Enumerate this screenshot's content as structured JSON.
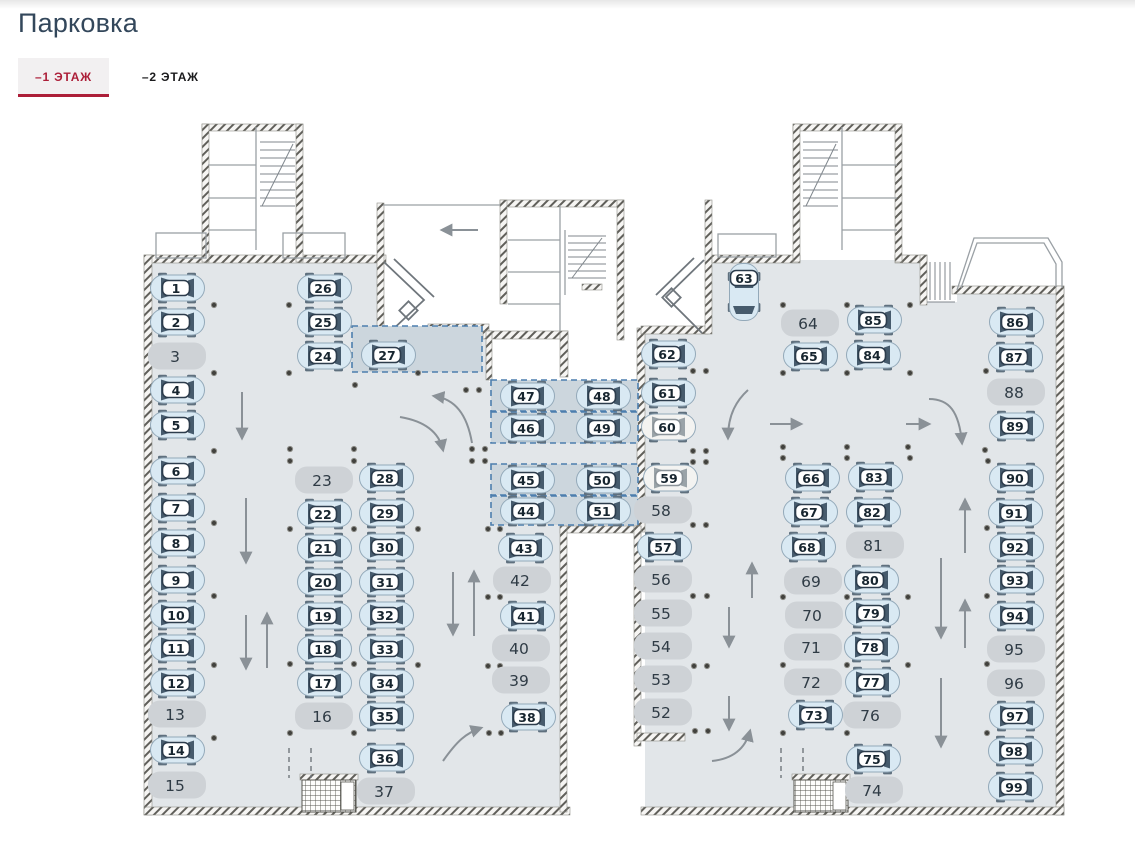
{
  "page": {
    "title": "Парковка"
  },
  "tabs": {
    "floor1": {
      "label": "–1 ЭТАЖ",
      "active": true
    },
    "floor2": {
      "label": "–2 ЭТАЖ",
      "active": false
    }
  },
  "plan": {
    "colors": {
      "floor": "#e2e6e9",
      "zone_fill": "#ccd6dd",
      "zone_border": "#4d7fae",
      "car_body": "#d9e9f3",
      "car_roof": "#eef5f9",
      "car_glass": "#465b6d",
      "car_wheel": "#5f707e",
      "car_outline": "#93a9b9",
      "white_body": "#f3f3f1",
      "white_glass": "#9aa3a8",
      "free_fill": "#ced2d6",
      "badge_fill": "#ffffff",
      "badge_border": "#2c3c4c",
      "number": "#17252f"
    },
    "zones": [
      {
        "x": 352,
        "y": 326,
        "w": 130,
        "h": 46
      },
      {
        "x": 491,
        "y": 380,
        "w": 147,
        "h": 31
      },
      {
        "x": 491,
        "y": 412,
        "w": 147,
        "h": 31
      },
      {
        "x": 491,
        "y": 464,
        "w": 147,
        "h": 31
      },
      {
        "x": 491,
        "y": 496,
        "w": 147,
        "h": 29
      }
    ],
    "spots": [
      {
        "n": 1,
        "x": 177,
        "y": 288,
        "s": "c"
      },
      {
        "n": 2,
        "x": 177,
        "y": 322,
        "s": "c"
      },
      {
        "n": 3,
        "x": 177,
        "y": 356,
        "s": "f"
      },
      {
        "n": 4,
        "x": 177,
        "y": 390,
        "s": "c"
      },
      {
        "n": 5,
        "x": 177,
        "y": 425,
        "s": "c"
      },
      {
        "n": 6,
        "x": 177,
        "y": 471,
        "s": "c"
      },
      {
        "n": 7,
        "x": 177,
        "y": 508,
        "s": "c"
      },
      {
        "n": 8,
        "x": 177,
        "y": 543,
        "s": "c"
      },
      {
        "n": 9,
        "x": 177,
        "y": 580,
        "s": "c"
      },
      {
        "n": 10,
        "x": 177,
        "y": 615,
        "s": "c"
      },
      {
        "n": 11,
        "x": 177,
        "y": 648,
        "s": "c"
      },
      {
        "n": 12,
        "x": 177,
        "y": 683,
        "s": "c"
      },
      {
        "n": 13,
        "x": 177,
        "y": 714,
        "s": "f"
      },
      {
        "n": 14,
        "x": 177,
        "y": 750,
        "s": "c"
      },
      {
        "n": 15,
        "x": 177,
        "y": 785,
        "s": "f"
      },
      {
        "n": 16,
        "x": 324,
        "y": 716,
        "s": "f"
      },
      {
        "n": 17,
        "x": 324,
        "y": 683,
        "s": "c"
      },
      {
        "n": 18,
        "x": 324,
        "y": 649,
        "s": "c"
      },
      {
        "n": 19,
        "x": 324,
        "y": 616,
        "s": "c"
      },
      {
        "n": 20,
        "x": 324,
        "y": 582,
        "s": "c"
      },
      {
        "n": 21,
        "x": 324,
        "y": 548,
        "s": "c"
      },
      {
        "n": 22,
        "x": 324,
        "y": 514,
        "s": "c"
      },
      {
        "n": 23,
        "x": 324,
        "y": 480,
        "s": "f"
      },
      {
        "n": 24,
        "x": 324,
        "y": 356,
        "s": "c"
      },
      {
        "n": 25,
        "x": 324,
        "y": 322,
        "s": "c"
      },
      {
        "n": 26,
        "x": 324,
        "y": 288,
        "s": "c"
      },
      {
        "n": 27,
        "x": 388,
        "y": 355,
        "s": "c"
      },
      {
        "n": 28,
        "x": 386,
        "y": 478,
        "s": "c"
      },
      {
        "n": 29,
        "x": 386,
        "y": 513,
        "s": "c"
      },
      {
        "n": 30,
        "x": 386,
        "y": 547,
        "s": "c"
      },
      {
        "n": 31,
        "x": 386,
        "y": 582,
        "s": "c"
      },
      {
        "n": 32,
        "x": 386,
        "y": 615,
        "s": "c"
      },
      {
        "n": 33,
        "x": 386,
        "y": 649,
        "s": "c"
      },
      {
        "n": 34,
        "x": 386,
        "y": 683,
        "s": "c"
      },
      {
        "n": 35,
        "x": 386,
        "y": 716,
        "s": "c"
      },
      {
        "n": 36,
        "x": 386,
        "y": 758,
        "s": "c"
      },
      {
        "n": 37,
        "x": 386,
        "y": 791,
        "s": "f"
      },
      {
        "n": 38,
        "x": 528,
        "y": 717,
        "s": "c"
      },
      {
        "n": 39,
        "x": 521,
        "y": 680,
        "s": "f"
      },
      {
        "n": 40,
        "x": 521,
        "y": 648,
        "s": "f"
      },
      {
        "n": 41,
        "x": 527,
        "y": 616,
        "s": "c"
      },
      {
        "n": 42,
        "x": 522,
        "y": 580,
        "s": "f"
      },
      {
        "n": 43,
        "x": 525,
        "y": 548,
        "s": "c"
      },
      {
        "n": 44,
        "x": 527,
        "y": 511,
        "s": "c"
      },
      {
        "n": 45,
        "x": 527,
        "y": 480,
        "s": "c"
      },
      {
        "n": 46,
        "x": 527,
        "y": 428,
        "s": "c"
      },
      {
        "n": 47,
        "x": 527,
        "y": 396,
        "s": "c"
      },
      {
        "n": 48,
        "x": 603,
        "y": 396,
        "s": "c"
      },
      {
        "n": 49,
        "x": 603,
        "y": 428,
        "s": "c"
      },
      {
        "n": 50,
        "x": 603,
        "y": 480,
        "s": "c"
      },
      {
        "n": 51,
        "x": 603,
        "y": 511,
        "s": "c"
      },
      {
        "n": 52,
        "x": 663,
        "y": 712,
        "s": "f"
      },
      {
        "n": 53,
        "x": 663,
        "y": 679,
        "s": "f"
      },
      {
        "n": 54,
        "x": 663,
        "y": 646,
        "s": "f"
      },
      {
        "n": 55,
        "x": 663,
        "y": 613,
        "s": "f"
      },
      {
        "n": 56,
        "x": 663,
        "y": 579,
        "s": "f"
      },
      {
        "n": 57,
        "x": 664,
        "y": 547,
        "s": "c"
      },
      {
        "n": 58,
        "x": 663,
        "y": 510,
        "s": "f"
      },
      {
        "n": 59,
        "x": 670,
        "y": 478,
        "s": "w"
      },
      {
        "n": 60,
        "x": 668,
        "y": 427,
        "s": "w"
      },
      {
        "n": 61,
        "x": 668,
        "y": 393,
        "s": "c"
      },
      {
        "n": 62,
        "x": 668,
        "y": 354,
        "s": "c"
      },
      {
        "n": 63,
        "x": 744,
        "y": 292,
        "s": "v"
      },
      {
        "n": 64,
        "x": 810,
        "y": 323,
        "s": "f"
      },
      {
        "n": 65,
        "x": 810,
        "y": 356,
        "s": "c"
      },
      {
        "n": 66,
        "x": 812,
        "y": 478,
        "s": "c"
      },
      {
        "n": 67,
        "x": 810,
        "y": 512,
        "s": "c"
      },
      {
        "n": 68,
        "x": 808,
        "y": 547,
        "s": "c"
      },
      {
        "n": 69,
        "x": 813,
        "y": 581,
        "s": "f"
      },
      {
        "n": 70,
        "x": 814,
        "y": 615,
        "s": "f"
      },
      {
        "n": 71,
        "x": 813,
        "y": 647,
        "s": "f"
      },
      {
        "n": 72,
        "x": 813,
        "y": 682,
        "s": "f"
      },
      {
        "n": 73,
        "x": 815,
        "y": 715,
        "s": "c"
      },
      {
        "n": 74,
        "x": 874,
        "y": 790,
        "s": "f"
      },
      {
        "n": 75,
        "x": 873,
        "y": 759,
        "s": "c"
      },
      {
        "n": 76,
        "x": 872,
        "y": 715,
        "s": "f"
      },
      {
        "n": 77,
        "x": 872,
        "y": 682,
        "s": "c"
      },
      {
        "n": 78,
        "x": 871,
        "y": 647,
        "s": "c"
      },
      {
        "n": 79,
        "x": 872,
        "y": 613,
        "s": "c"
      },
      {
        "n": 80,
        "x": 871,
        "y": 580,
        "s": "c"
      },
      {
        "n": 81,
        "x": 875,
        "y": 545,
        "s": "f"
      },
      {
        "n": 82,
        "x": 873,
        "y": 512,
        "s": "c"
      },
      {
        "n": 83,
        "x": 875,
        "y": 477,
        "s": "c"
      },
      {
        "n": 84,
        "x": 873,
        "y": 355,
        "s": "c"
      },
      {
        "n": 85,
        "x": 874,
        "y": 320,
        "s": "c"
      },
      {
        "n": 86,
        "x": 1016,
        "y": 322,
        "s": "c"
      },
      {
        "n": 87,
        "x": 1015,
        "y": 357,
        "s": "c"
      },
      {
        "n": 88,
        "x": 1016,
        "y": 392,
        "s": "f"
      },
      {
        "n": 89,
        "x": 1016,
        "y": 426,
        "s": "c"
      },
      {
        "n": 90,
        "x": 1016,
        "y": 478,
        "s": "c"
      },
      {
        "n": 91,
        "x": 1015,
        "y": 513,
        "s": "c"
      },
      {
        "n": 92,
        "x": 1016,
        "y": 547,
        "s": "c"
      },
      {
        "n": 93,
        "x": 1016,
        "y": 580,
        "s": "c"
      },
      {
        "n": 94,
        "x": 1016,
        "y": 616,
        "s": "c"
      },
      {
        "n": 95,
        "x": 1016,
        "y": 649,
        "s": "f"
      },
      {
        "n": 96,
        "x": 1016,
        "y": 683,
        "s": "f"
      },
      {
        "n": 97,
        "x": 1016,
        "y": 716,
        "s": "c"
      },
      {
        "n": 98,
        "x": 1015,
        "y": 751,
        "s": "c"
      },
      {
        "n": 99,
        "x": 1015,
        "y": 787,
        "s": "c"
      }
    ]
  }
}
